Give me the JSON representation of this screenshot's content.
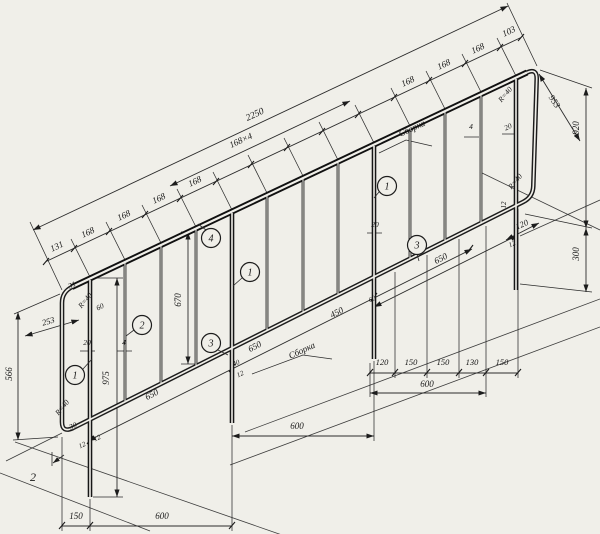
{
  "drawing": {
    "kind": "axonometric assembly drawing of welded stair railing panel",
    "language": "ru",
    "dims": {
      "overall_length": "2250",
      "picket_group": "168×4",
      "picket_step": "168",
      "step_first": "131",
      "step_last": "103",
      "left_end_height": "566",
      "left_end_diagonal": "253",
      "post_length": "975",
      "picket_length": "670",
      "corner_radius": "R=40",
      "corner_chamfer": "31",
      "weld_len_60": "60",
      "offset_20": "20",
      "weld_size_4": "4",
      "gap_12": "12",
      "gap_30": "30",
      "gap_40": "40",
      "bay_slope_650": "650",
      "bay_horiz_600": "600",
      "slope_seg_450": "450",
      "base_150": "150",
      "chain_120": "120",
      "chain_130": "130",
      "right_end_height": "920",
      "right_end_diagonal": "953",
      "post_below_300": "300"
    },
    "notes": {
      "assembly": "Сборка",
      "section_mark": "2"
    },
    "callouts": {
      "c1": "1",
      "c2": "2",
      "c3": "3",
      "c4": "4"
    }
  }
}
